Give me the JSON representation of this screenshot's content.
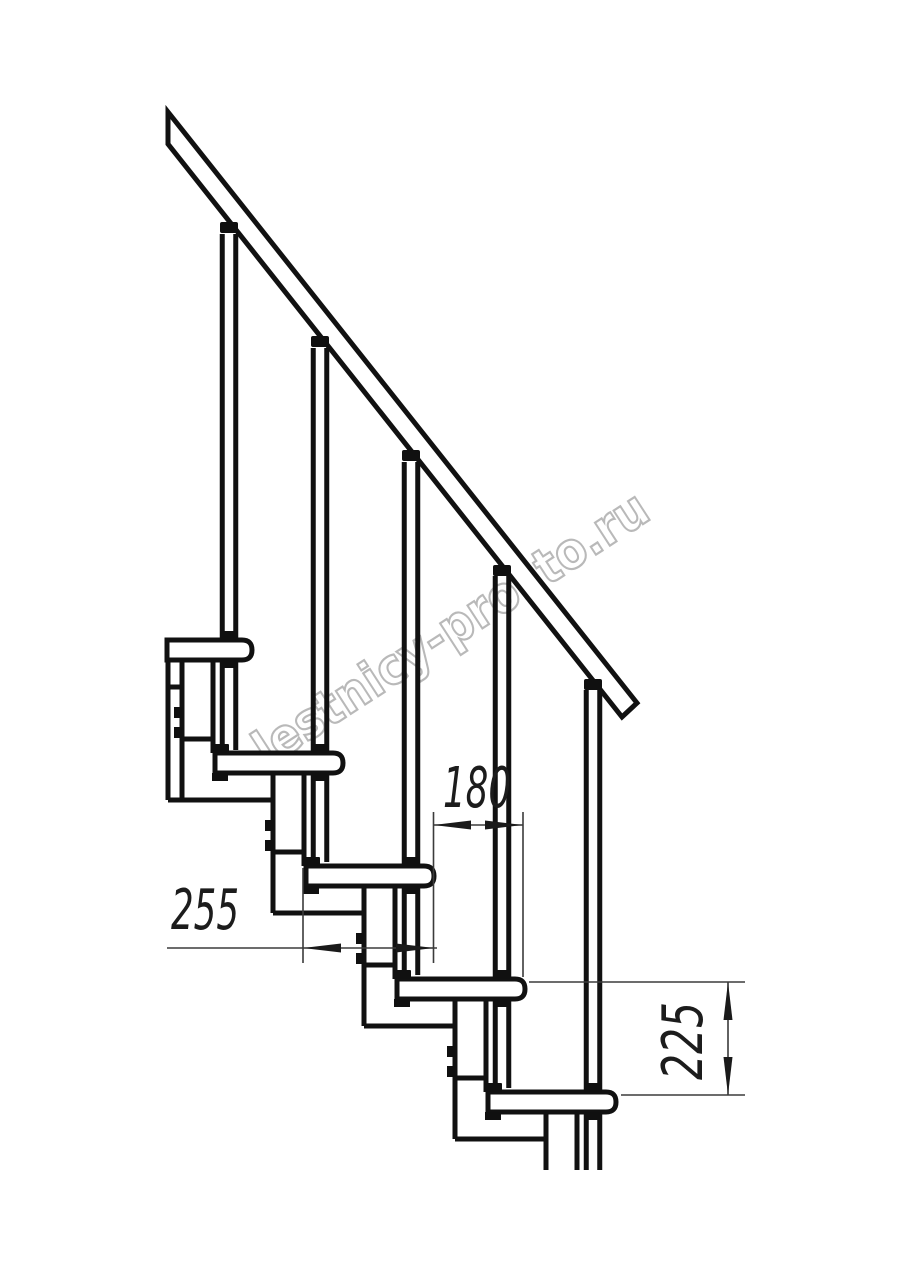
{
  "page": {
    "background": "#ffffff"
  },
  "watermark": {
    "text": "lestnicy-prosto.ru",
    "outline_color": "#b9b9b9"
  },
  "drawing": {
    "type": "staircase-side-view-technical-drawing",
    "line_color": "#111111",
    "dimension_line_color": "#3b3b3b",
    "dimension_text_color": "#1c1c1c",
    "counts": {
      "treads": 5,
      "balusters": 5,
      "support_modules": 5,
      "handrails": 1
    },
    "dimensions": [
      {
        "id": "tread-depth",
        "value": "255",
        "orientation": "horizontal"
      },
      {
        "id": "step-run",
        "value": "180",
        "orientation": "horizontal"
      },
      {
        "id": "step-rise",
        "value": "225",
        "orientation": "vertical"
      }
    ]
  }
}
